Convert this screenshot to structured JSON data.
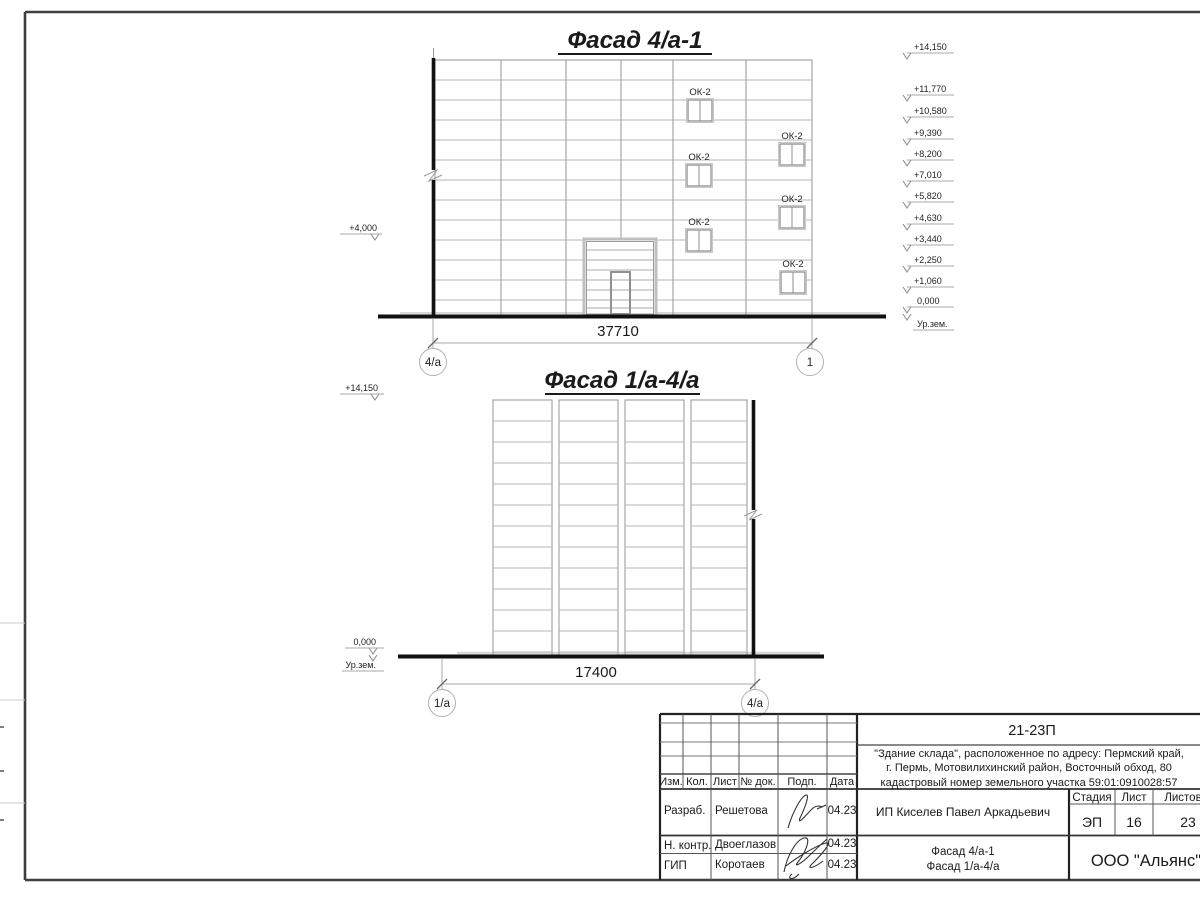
{
  "facade1": {
    "title": "Фасад 4/а-1",
    "left_elevation": "+4,000",
    "right_elevations": [
      "+14,150",
      "+11,770",
      "+10,580",
      "+9,390",
      "+8,200",
      "+7,010",
      "+5,820",
      "+4,630",
      "+3,440",
      "+2,250",
      "+1,060",
      "0,000"
    ],
    "ground_level_label": "Ур.зем.",
    "window_tag": "ОК-2",
    "overall_dimension": "37710",
    "axis_start": "4/а",
    "axis_end": "1"
  },
  "facade2": {
    "title": "Фасад 1/а-4/а",
    "top_elevation": "+14,150",
    "zero_elevation": "0,000",
    "ground_level_label": "Ур.зем.",
    "overall_dimension": "17400",
    "axis_start": "1/а",
    "axis_end": "4/а"
  },
  "title_block": {
    "project_code": "21-23П",
    "description_lines": [
      "\"Здание склада\", расположенное по адресу: Пермский край,",
      "г. Пермь, Мотовилихинский район, Восточный обход, 80",
      "кадастровый номер земельного участка 59:01:0910028:57"
    ],
    "revision_columns": [
      "Изм.",
      "Кол.",
      "Лист",
      "№ док.",
      "Подп.",
      "Дата"
    ],
    "signature_rows": [
      {
        "role": "Разраб.",
        "name": "Решетова",
        "date": "04.23"
      },
      {
        "role": "Н. контр.",
        "name": "Двоеглазов",
        "date": "04.23"
      },
      {
        "role": "ГИП",
        "name": "Коротаев",
        "date": "04.23"
      }
    ],
    "client": "ИП Киселев Павел Аркадьевич",
    "stage_header": "Стадия",
    "stage_value": "ЭП",
    "sheet_header": "Лист",
    "sheet_value": "16",
    "sheets_header": "Листов",
    "sheets_value": "23",
    "sheet_content_lines": [
      "Фасад 4/а-1",
      "Фасад 1/а-4/а"
    ],
    "organization": "ООО \"Альянс\""
  }
}
